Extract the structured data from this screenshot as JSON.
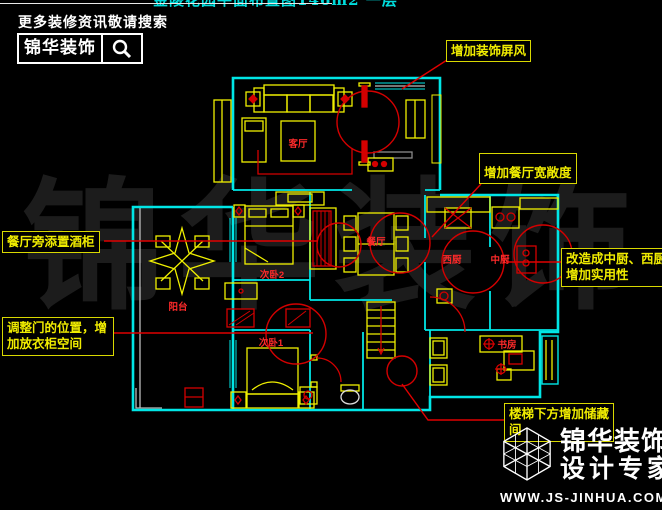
{
  "header": {
    "search_hint": "更多装修资讯敬请搜索",
    "brand": "锦华装饰"
  },
  "top_title": "金陵花园平面布置图146m2 一层",
  "watermark": "锦华装饰",
  "annotations": {
    "screen": "增加装饰屏风",
    "dining": "增加餐厅宽敞度",
    "kitchen": "改造成中厨、西厨\n增加实用性",
    "wine": "餐厅旁添置酒柜",
    "door": "调整门的位置，增\n加放衣柜空间",
    "stairs": "楼梯下方增加储藏\n间"
  },
  "rooms": {
    "living": "客厅",
    "dining": "餐厅",
    "balcony": "阳台",
    "bedroom2": "次卧2",
    "bedroom1": "次卧1",
    "west_kitchen": "西厨",
    "mid_kitchen": "中厨",
    "study": "书房"
  },
  "footer": {
    "brand": "锦华装饰",
    "tagline": "设计专家",
    "url": "WWW.JS-JINHUA.COM"
  },
  "colors": {
    "wall": "#00e6e6",
    "furniture": "#f0f000",
    "highlight": "#d40000",
    "label": "#ff2a2a",
    "note": "#f0ec00"
  }
}
